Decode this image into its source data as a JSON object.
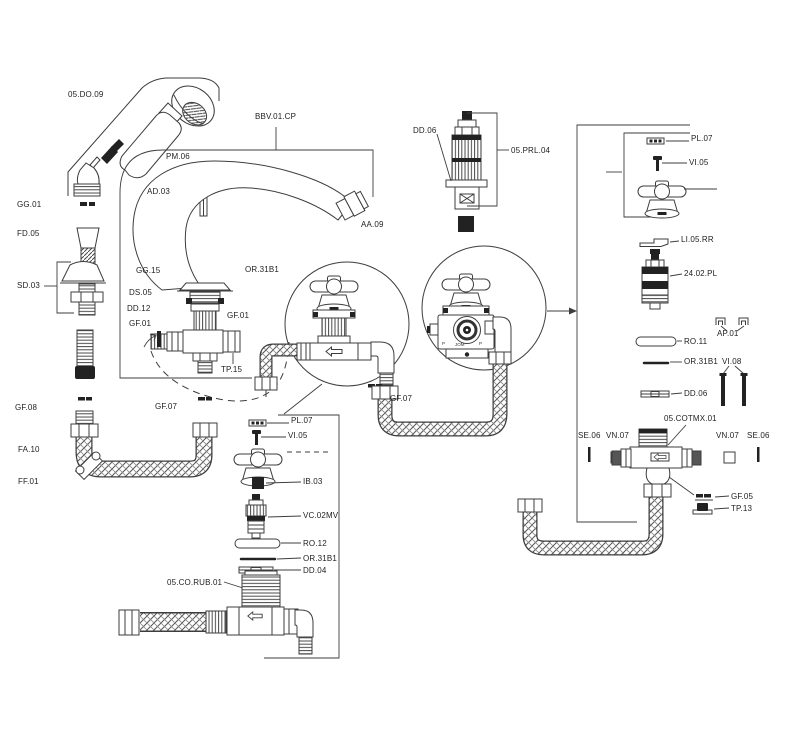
{
  "diagram_type": "exploded-parts-diagram-faucet",
  "colors": {
    "line": "#3d3d3d",
    "fill_dark": "#222222",
    "background": "#ffffff"
  },
  "labels": {
    "do09": "05.DO.09",
    "gg01": "GG.01",
    "fd05": "FD.05",
    "sd03": "SD.03",
    "gf08": "GF.08",
    "fa10": "FA.10",
    "ff01": "FF.01",
    "bbv01cp": "BBV.01.CP",
    "pm06": "PM.06",
    "ad03": "AD.03",
    "aa09": "AA.09",
    "gg15": "GG.15",
    "or31b1": "OR.31B1",
    "ds05": "DS.05",
    "dd12": "DD.12",
    "gf01": "GF.01",
    "tp15": "TP.15",
    "gf07": "GF.07",
    "dd06": "DD.06",
    "prl04": "05.PRL.04",
    "pl07": "PL.07",
    "vi05": "VI.05",
    "li05rr": "LI.05.RR",
    "pl2402": "24.02.PL",
    "ap01": "AP.01",
    "ro11": "RO.11",
    "vi08": "VI.08",
    "se06": "SE.06",
    "vn07": "VN.07",
    "cotmx01": "05.COTMX.01",
    "gf05": "GF.05",
    "tp13": "TP.13",
    "ib03": "IB.03",
    "vc02mv": "VC.02MV",
    "ro12": "RO.12",
    "dd04": "DD.04",
    "corub01": "05.CO.RUB.01"
  },
  "detail_marks": {
    "left": "P",
    "center": "JOM",
    "right": "P"
  }
}
